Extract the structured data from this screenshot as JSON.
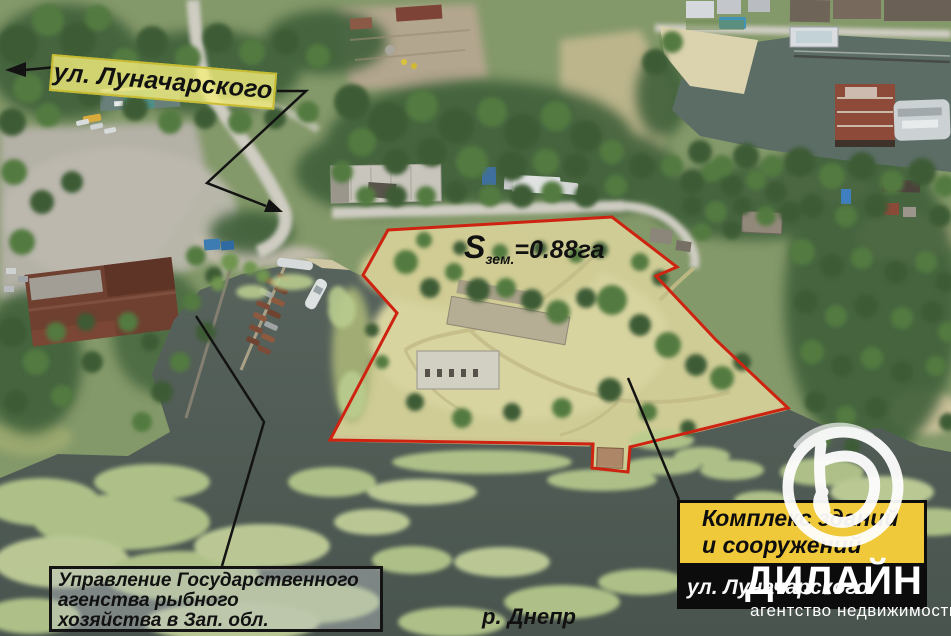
{
  "colors": {
    "outline_red": "#ce2310",
    "label_yellow": "#f0c93a",
    "street_label_bg": "rgba(244,238,125,0.8)",
    "street_label_border": "rgba(198,184,42,0.9)",
    "annotation_black": "#131313",
    "watermark_white": "#ffffff",
    "water": "#515d57",
    "property_grass": "#d3cf98"
  },
  "annotations": {
    "street_label": "ул. Луначарского",
    "area_label": {
      "symbol": "S",
      "subscript": "зем.",
      "value": "=0.88га"
    },
    "fishery_box": {
      "line1": "Управление Государственного",
      "line2": "агенства рыбного",
      "line3": "хозяйства в Зап. обл."
    },
    "complex_box": {
      "line1": "Комплекс зданий",
      "line2": "и сооружений",
      "address": "ул. Луначарского"
    },
    "river_label": "р. Днепр"
  },
  "watermark": {
    "brand": "ДИЛАЙН",
    "tagline": "агентство недвижимости",
    "logo_icon": "brush-circle-d-icon"
  }
}
